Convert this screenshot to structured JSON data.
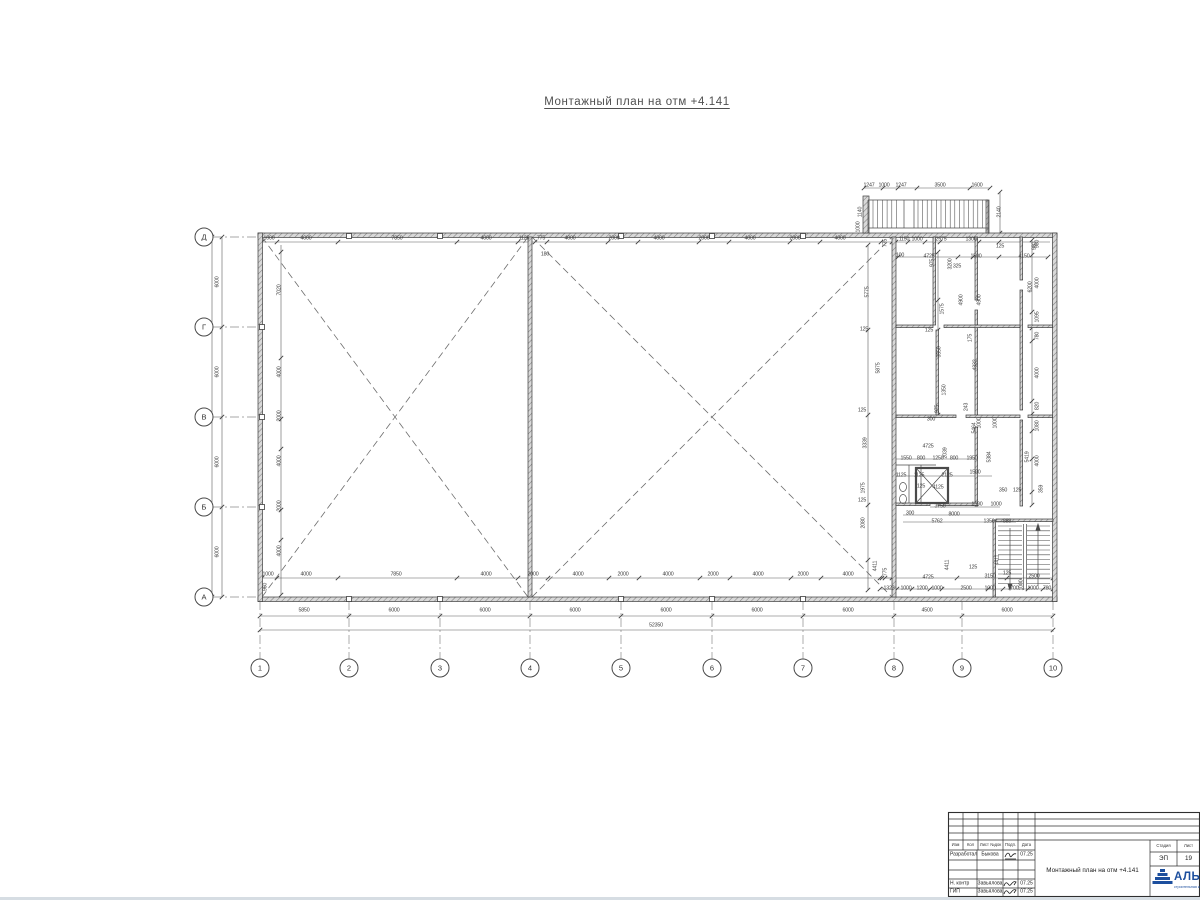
{
  "title": {
    "text": "Монтажный план на отм +4.141"
  },
  "plan": {
    "axes_bottom": [
      {
        "label": "1",
        "x": 260
      },
      {
        "label": "2",
        "x": 349
      },
      {
        "label": "3",
        "x": 440
      },
      {
        "label": "4",
        "x": 530
      },
      {
        "label": "5",
        "x": 621
      },
      {
        "label": "6",
        "x": 712
      },
      {
        "label": "7",
        "x": 803
      },
      {
        "label": "8",
        "x": 894
      },
      {
        "label": "9",
        "x": 962
      },
      {
        "label": "10",
        "x": 1053
      }
    ],
    "axes_left": [
      {
        "label": "Д",
        "y": 237
      },
      {
        "label": "Г",
        "y": 327
      },
      {
        "label": "В",
        "y": 417
      },
      {
        "label": "Б",
        "y": 507
      },
      {
        "label": "А",
        "y": 597
      }
    ],
    "labels": [
      {
        "t": "5850",
        "x": 304,
        "y": 611
      },
      {
        "t": "6000",
        "x": 394,
        "y": 611
      },
      {
        "t": "6000",
        "x": 485,
        "y": 611
      },
      {
        "t": "6000",
        "x": 575,
        "y": 611
      },
      {
        "t": "6000",
        "x": 666,
        "y": 611
      },
      {
        "t": "6000",
        "x": 757,
        "y": 611
      },
      {
        "t": "6000",
        "x": 848,
        "y": 611
      },
      {
        "t": "4500",
        "x": 927,
        "y": 611
      },
      {
        "t": "6000",
        "x": 1007,
        "y": 611
      },
      {
        "t": "52350",
        "x": 656,
        "y": 626
      },
      {
        "t": "6000",
        "x": 218,
        "y": 282,
        "r": 1
      },
      {
        "t": "6000",
        "x": 218,
        "y": 372,
        "r": 1
      },
      {
        "t": "6000",
        "x": 218,
        "y": 462,
        "r": 1
      },
      {
        "t": "6000",
        "x": 218,
        "y": 552,
        "r": 1
      },
      {
        "t": "24000",
        "x": 207,
        "y": 417,
        "r": 1
      },
      {
        "t": "1000",
        "x": 269,
        "y": 239
      },
      {
        "t": "4000",
        "x": 306,
        "y": 239
      },
      {
        "t": "7850",
        "x": 397,
        "y": 239
      },
      {
        "t": "4000",
        "x": 486,
        "y": 239
      },
      {
        "t": "1125",
        "x": 524,
        "y": 239
      },
      {
        "t": "775",
        "x": 541,
        "y": 239
      },
      {
        "t": "180",
        "x": 545,
        "y": 255
      },
      {
        "t": "4000",
        "x": 570,
        "y": 239
      },
      {
        "t": "2000",
        "x": 614,
        "y": 239
      },
      {
        "t": "4000",
        "x": 659,
        "y": 239
      },
      {
        "t": "2000",
        "x": 704,
        "y": 239
      },
      {
        "t": "4000",
        "x": 750,
        "y": 239
      },
      {
        "t": "2000",
        "x": 795,
        "y": 239
      },
      {
        "t": "4000",
        "x": 840,
        "y": 239
      },
      {
        "t": "1000",
        "x": 268,
        "y": 575
      },
      {
        "t": "4000",
        "x": 306,
        "y": 575
      },
      {
        "t": "7850",
        "x": 396,
        "y": 575
      },
      {
        "t": "4000",
        "x": 486,
        "y": 575
      },
      {
        "t": "2000",
        "x": 533,
        "y": 575
      },
      {
        "t": "4000",
        "x": 578,
        "y": 575
      },
      {
        "t": "2000",
        "x": 623,
        "y": 575
      },
      {
        "t": "4000",
        "x": 668,
        "y": 575
      },
      {
        "t": "2000",
        "x": 713,
        "y": 575
      },
      {
        "t": "4000",
        "x": 758,
        "y": 575
      },
      {
        "t": "2000",
        "x": 803,
        "y": 575
      },
      {
        "t": "4000",
        "x": 848,
        "y": 575
      },
      {
        "t": "960",
        "x": 266,
        "y": 587,
        "r": 1
      },
      {
        "t": "7020",
        "x": 280,
        "y": 290,
        "r": 1
      },
      {
        "t": "4000",
        "x": 280,
        "y": 372,
        "r": 1
      },
      {
        "t": "2000",
        "x": 280,
        "y": 416,
        "r": 1
      },
      {
        "t": "4000",
        "x": 280,
        "y": 461,
        "r": 1
      },
      {
        "t": "2000",
        "x": 280,
        "y": 506,
        "r": 1
      },
      {
        "t": "4000",
        "x": 280,
        "y": 551,
        "r": 1
      },
      {
        "t": "1247",
        "x": 869,
        "y": 186
      },
      {
        "t": "1000",
        "x": 884,
        "y": 186
      },
      {
        "t": "1247",
        "x": 901,
        "y": 186
      },
      {
        "t": "3500",
        "x": 940,
        "y": 186
      },
      {
        "t": "1600",
        "x": 977,
        "y": 186
      },
      {
        "t": "1140",
        "x": 861,
        "y": 212,
        "r": 1
      },
      {
        "t": "1000",
        "x": 859,
        "y": 227,
        "r": 1
      },
      {
        "t": "2140",
        "x": 1000,
        "y": 212,
        "r": 1
      },
      {
        "t": "775",
        "x": 886,
        "y": 243,
        "r": 1
      },
      {
        "t": "1150",
        "x": 904,
        "y": 240
      },
      {
        "t": "1000",
        "x": 917,
        "y": 240
      },
      {
        "t": "2575",
        "x": 941,
        "y": 240
      },
      {
        "t": "1300",
        "x": 971,
        "y": 240
      },
      {
        "t": "125",
        "x": 1000,
        "y": 247
      },
      {
        "t": "980",
        "x": 1035,
        "y": 246,
        "r": 1
      },
      {
        "t": "100",
        "x": 900,
        "y": 256
      },
      {
        "t": "4725",
        "x": 929,
        "y": 257
      },
      {
        "t": "3200",
        "x": 951,
        "y": 264,
        "r": 1
      },
      {
        "t": "1500",
        "x": 976,
        "y": 257
      },
      {
        "t": "4150",
        "x": 1024,
        "y": 257
      },
      {
        "t": "325",
        "x": 957,
        "y": 267
      },
      {
        "t": "5775",
        "x": 868,
        "y": 292,
        "r": 1
      },
      {
        "t": "5875",
        "x": 879,
        "y": 368,
        "r": 1
      },
      {
        "t": "4900",
        "x": 962,
        "y": 300,
        "r": 1
      },
      {
        "t": "4900",
        "x": 980,
        "y": 300,
        "r": 1
      },
      {
        "t": "6200",
        "x": 1031,
        "y": 287,
        "r": 1
      },
      {
        "t": "975",
        "x": 933,
        "y": 263,
        "r": 1
      },
      {
        "t": "1575",
        "x": 943,
        "y": 309,
        "r": 1
      },
      {
        "t": "125",
        "x": 929,
        "y": 331
      },
      {
        "t": "3550",
        "x": 940,
        "y": 352,
        "r": 1
      },
      {
        "t": "175",
        "x": 971,
        "y": 338,
        "r": 1
      },
      {
        "t": "4332",
        "x": 976,
        "y": 365,
        "r": 1
      },
      {
        "t": "1350",
        "x": 945,
        "y": 390,
        "r": 1
      },
      {
        "t": "975",
        "x": 938,
        "y": 409,
        "r": 1
      },
      {
        "t": "243",
        "x": 967,
        "y": 407,
        "r": 1
      },
      {
        "t": "300",
        "x": 931,
        "y": 420
      },
      {
        "t": "1000",
        "x": 980,
        "y": 423,
        "r": 1
      },
      {
        "t": "1000",
        "x": 996,
        "y": 423,
        "r": 1
      },
      {
        "t": "5464",
        "x": 975,
        "y": 428,
        "r": 1
      },
      {
        "t": "5384",
        "x": 990,
        "y": 457,
        "r": 1
      },
      {
        "t": "5419",
        "x": 1028,
        "y": 457,
        "r": 1
      },
      {
        "t": "980",
        "x": 1038,
        "y": 244,
        "r": 1
      },
      {
        "t": "4000",
        "x": 1038,
        "y": 283,
        "r": 1
      },
      {
        "t": "1095",
        "x": 1038,
        "y": 317,
        "r": 1
      },
      {
        "t": "780",
        "x": 1038,
        "y": 336,
        "r": 1
      },
      {
        "t": "4000",
        "x": 1038,
        "y": 373,
        "r": 1
      },
      {
        "t": "820",
        "x": 1038,
        "y": 406,
        "r": 1
      },
      {
        "t": "1080",
        "x": 1038,
        "y": 426,
        "r": 1
      },
      {
        "t": "4000",
        "x": 1038,
        "y": 461,
        "r": 1
      },
      {
        "t": "359",
        "x": 1042,
        "y": 489,
        "r": 1
      },
      {
        "t": "3339",
        "x": 866,
        "y": 443,
        "r": 1
      },
      {
        "t": "1975",
        "x": 864,
        "y": 488,
        "r": 1
      },
      {
        "t": "2080",
        "x": 864,
        "y": 523,
        "r": 1
      },
      {
        "t": "125",
        "x": 862,
        "y": 411
      },
      {
        "t": "125",
        "x": 862,
        "y": 501
      },
      {
        "t": "125",
        "x": 864,
        "y": 330
      },
      {
        "t": "4725",
        "x": 928,
        "y": 447
      },
      {
        "t": "2039",
        "x": 946,
        "y": 453,
        "r": 1
      },
      {
        "t": "1550",
        "x": 906,
        "y": 459
      },
      {
        "t": "800",
        "x": 921,
        "y": 459
      },
      {
        "t": "1250",
        "x": 938,
        "y": 459
      },
      {
        "t": "800",
        "x": 954,
        "y": 459
      },
      {
        "t": "1950",
        "x": 972,
        "y": 459
      },
      {
        "t": "1125",
        "x": 901,
        "y": 476
      },
      {
        "t": "1125",
        "x": 919,
        "y": 476
      },
      {
        "t": "2125",
        "x": 947,
        "y": 476
      },
      {
        "t": "1500",
        "x": 975,
        "y": 473
      },
      {
        "t": "4125",
        "x": 938,
        "y": 488
      },
      {
        "t": "125",
        "x": 921,
        "y": 487
      },
      {
        "t": "350",
        "x": 1003,
        "y": 491
      },
      {
        "t": "125",
        "x": 1017,
        "y": 491
      },
      {
        "t": "3750",
        "x": 940,
        "y": 507
      },
      {
        "t": "1500",
        "x": 977,
        "y": 505
      },
      {
        "t": "1000",
        "x": 996,
        "y": 505
      },
      {
        "t": "300",
        "x": 910,
        "y": 514
      },
      {
        "t": "8000",
        "x": 954,
        "y": 515
      },
      {
        "t": "5762",
        "x": 937,
        "y": 522
      },
      {
        "t": "1350",
        "x": 989,
        "y": 522
      },
      {
        "t": "888",
        "x": 1007,
        "y": 522
      },
      {
        "t": "4411",
        "x": 998,
        "y": 560,
        "r": 1
      },
      {
        "t": "4411",
        "x": 948,
        "y": 565,
        "r": 1
      },
      {
        "t": "4411",
        "x": 876,
        "y": 566,
        "r": 1
      },
      {
        "t": "775",
        "x": 886,
        "y": 572,
        "r": 1
      },
      {
        "t": "125",
        "x": 973,
        "y": 568
      },
      {
        "t": "3150",
        "x": 990,
        "y": 577
      },
      {
        "t": "125",
        "x": 1007,
        "y": 574
      },
      {
        "t": "2500",
        "x": 1034,
        "y": 577
      },
      {
        "t": "4725",
        "x": 928,
        "y": 578
      },
      {
        "t": "1323",
        "x": 889,
        "y": 589
      },
      {
        "t": "1000",
        "x": 906,
        "y": 589
      },
      {
        "t": "1200",
        "x": 922,
        "y": 589
      },
      {
        "t": "1000",
        "x": 937,
        "y": 589
      },
      {
        "t": "2500",
        "x": 966,
        "y": 589
      },
      {
        "t": "1000",
        "x": 990,
        "y": 589
      },
      {
        "t": "1700",
        "x": 1013,
        "y": 589
      },
      {
        "t": "1000",
        "x": 1022,
        "y": 585,
        "r": 1
      },
      {
        "t": "1000",
        "x": 1033,
        "y": 589
      },
      {
        "t": "780",
        "x": 1047,
        "y": 589
      }
    ]
  },
  "titleblock": {
    "header": [
      "Изм",
      "Кол",
      "Лист №док",
      "Подп.",
      "Дата"
    ],
    "rows": [
      {
        "role": "Разработал",
        "name": "Быкова",
        "date": "07.25"
      },
      {
        "role": "",
        "name": "",
        "date": ""
      },
      {
        "role": "Н. контр",
        "name": "Завьялова",
        "date": "07.25"
      },
      {
        "role": "ГИП",
        "name": "Завьялова",
        "date": "07.25"
      }
    ],
    "doc_title": "Монтажный план на отм +4.141",
    "stage_label": "Стадия",
    "sheet_label": "Лист",
    "stage": "ЭП",
    "sheet_no": "19",
    "company": "АЛЬЯНС",
    "company_sub": "строительная компания",
    "accent": "#1d4f9e"
  }
}
